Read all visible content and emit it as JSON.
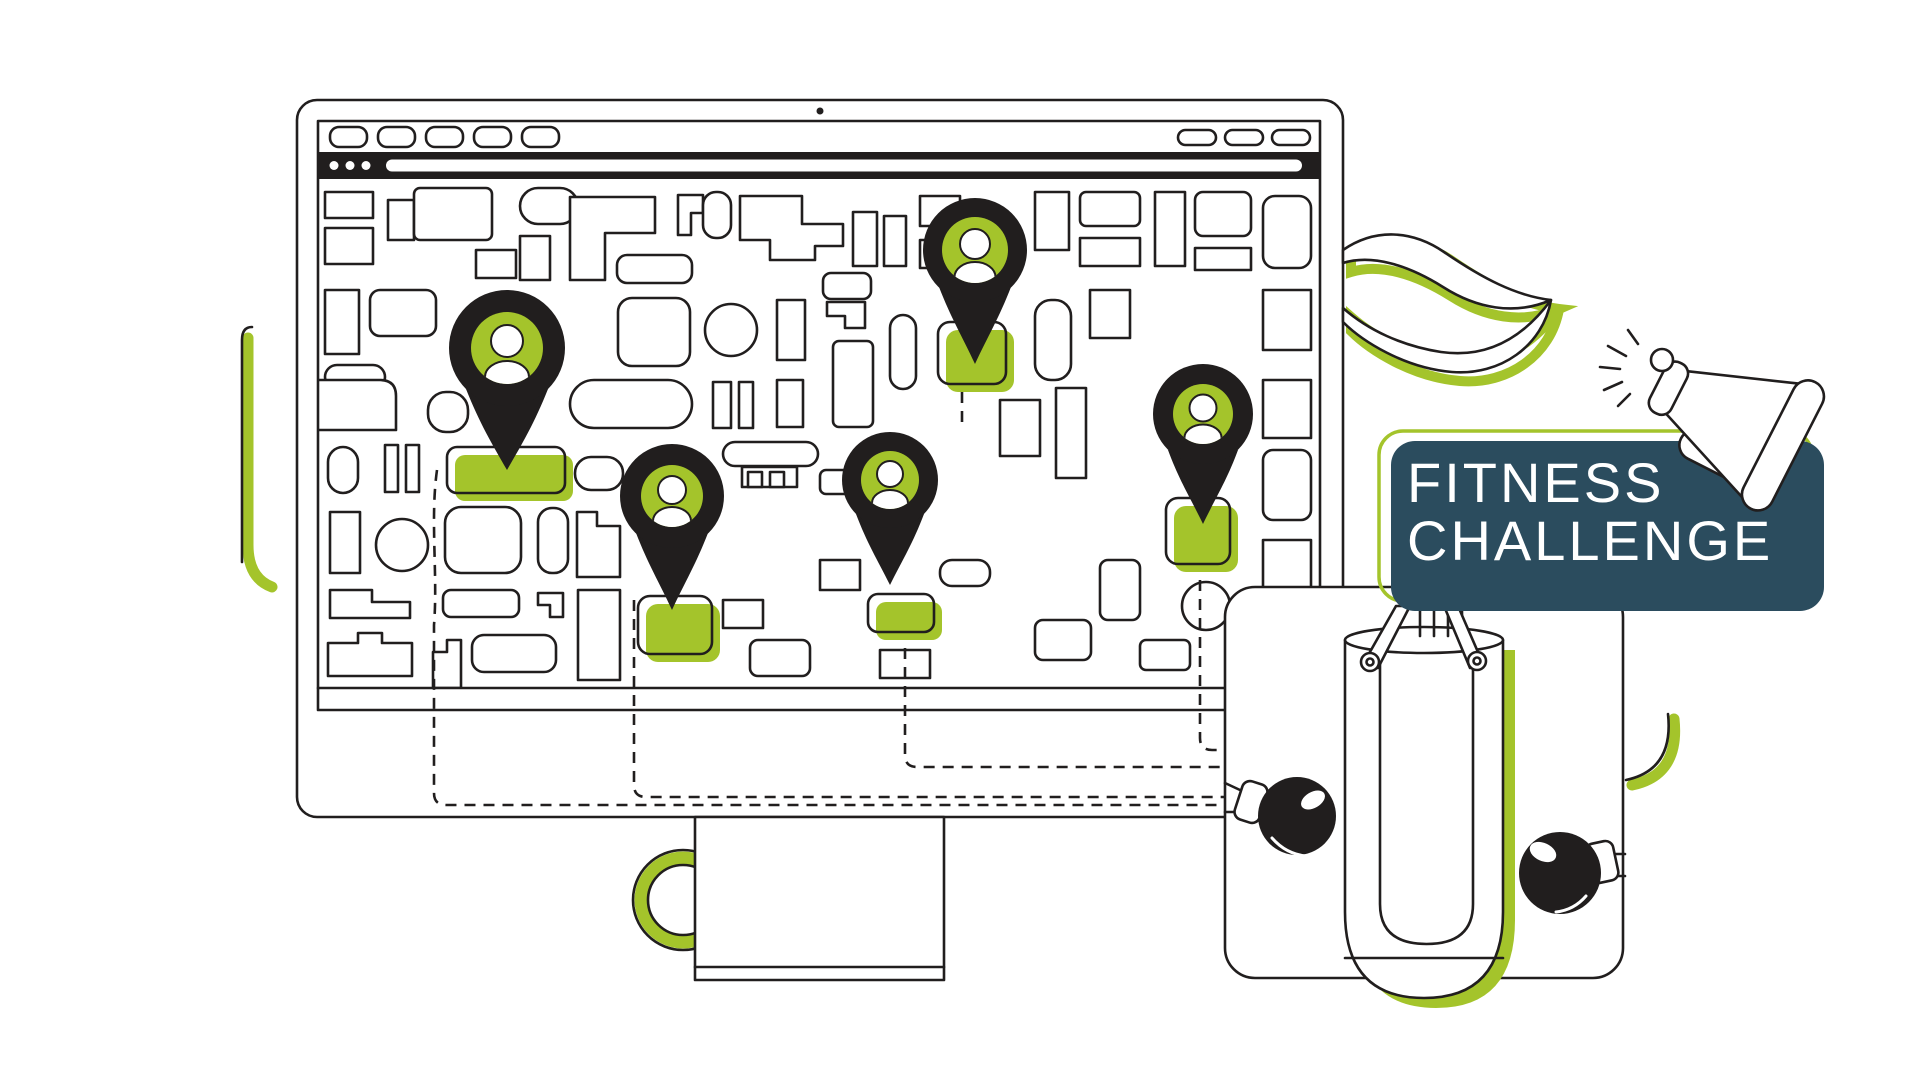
{
  "scene": {
    "badge": {
      "line1": "FITNESS",
      "line2": "CHALLENGE",
      "bg_color": "#2b4c5e",
      "outline_color": "#a4c42b",
      "text_color": "#ffffff"
    },
    "monitor": {
      "camera_dot": true,
      "browser": {
        "tab_count": 5,
        "window_control_count": 3,
        "address_dot_count": 3
      },
      "map": {
        "pin_count": 5,
        "highlighted_building_count": 5,
        "pin_color": "#211e1e",
        "pin_head_color": "#a4c42b"
      }
    },
    "decor": {
      "items": [
        "leaf",
        "megaphone",
        "punching-bag",
        "boxing-gloves",
        "green-ring"
      ]
    },
    "colors": {
      "accent_green": "#a4c42b",
      "ink": "#211e1e",
      "navy": "#2b4c5e",
      "background": "#ffffff"
    }
  }
}
